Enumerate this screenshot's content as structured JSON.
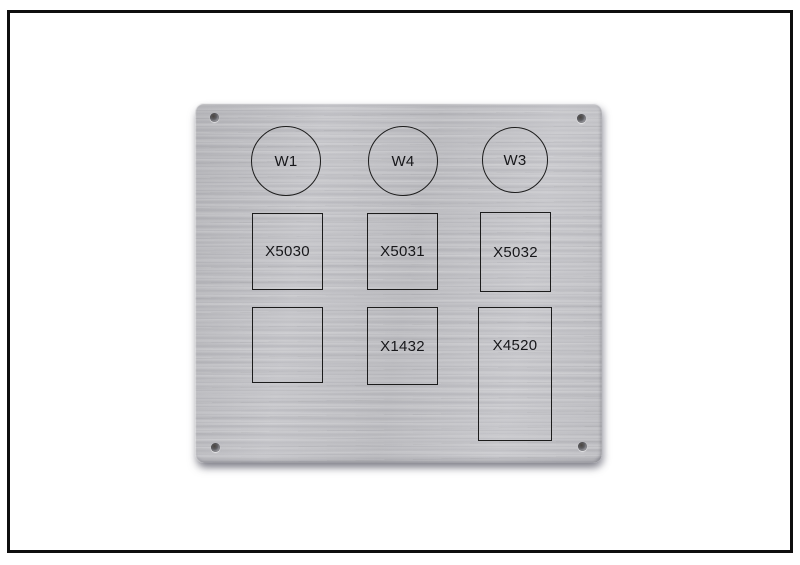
{
  "plate": {
    "circles": [
      {
        "label": "W1"
      },
      {
        "label": "W4"
      },
      {
        "label": "W3"
      }
    ],
    "middle_row": [
      {
        "label": "X5030"
      },
      {
        "label": "X5031"
      },
      {
        "label": "X5032"
      }
    ],
    "bottom_row": [
      {
        "label": ""
      },
      {
        "label": "X1432"
      },
      {
        "label": "X4520"
      }
    ],
    "colors": {
      "plate_base": "#c1c1c5",
      "engraving_line": "#1c1c1c",
      "frame_border": "#0f0f0f",
      "background": "#ffffff"
    }
  }
}
